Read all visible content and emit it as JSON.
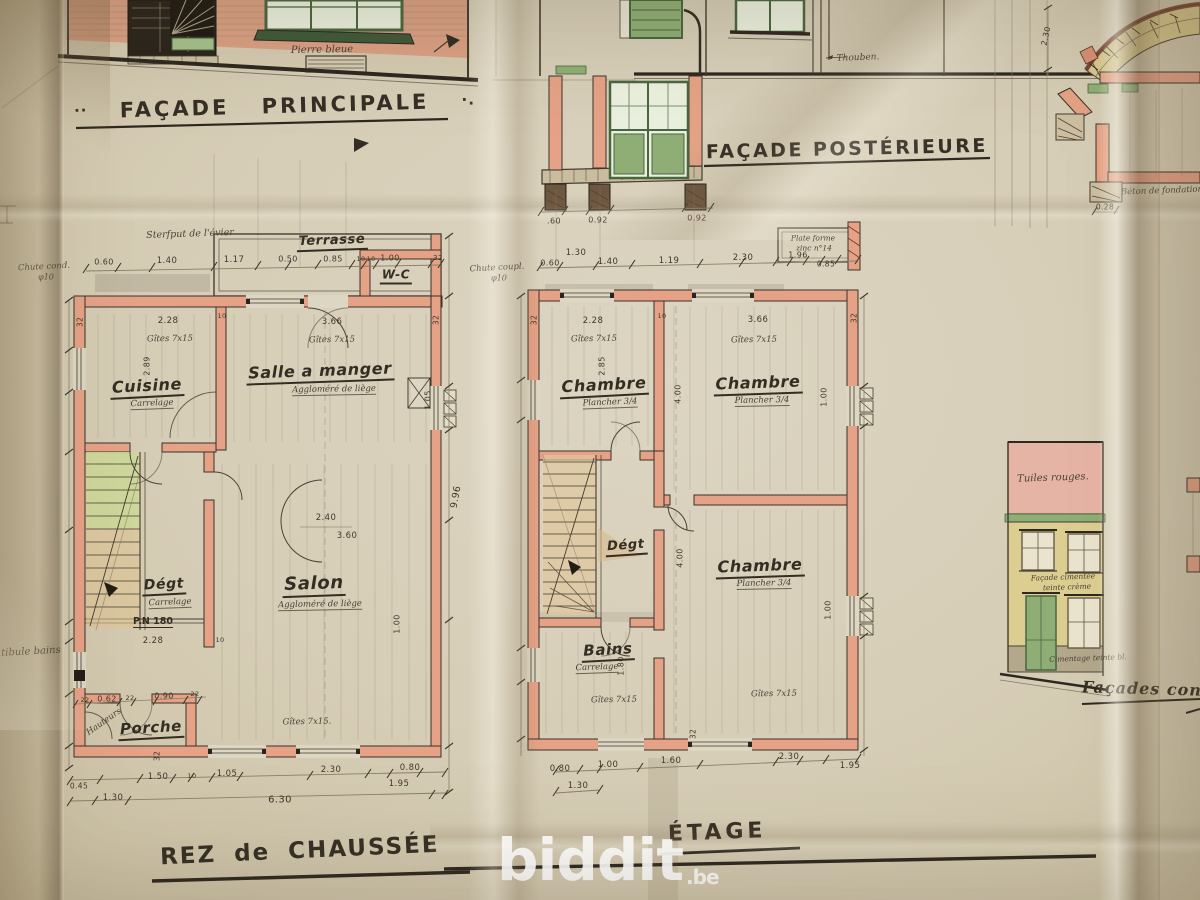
{
  "palette": {
    "paper": "#d6cdb6",
    "ink": "#443c2f",
    "wall_salmon": "#e5a286",
    "joinery_green": "#8fae75",
    "brick_yellow": "#d8c98f",
    "roof_pink": "#e6b4a5",
    "stair_green": "#ccd897",
    "watermark_white": "#ffffff"
  },
  "titles": {
    "principale": {
      "pre": "··",
      "text": "FAÇADE PRINCIPALE",
      "post": "·."
    },
    "posterieure": {
      "text": "FAÇADE POSTÉRIEURE"
    },
    "rdc": {
      "text": "REZ de CHAUSSÉE"
    },
    "etage": {
      "text": "ÉTAGE"
    },
    "laterales": {
      "text": "Façades con"
    }
  },
  "watermark": {
    "text": "biddit",
    "tld": ".be"
  },
  "ann": {
    "principale": [
      {
        "t": "Pierre bleue",
        "x": 322,
        "y": 50,
        "c": "cur",
        "s": 10,
        "r": -1
      }
    ],
    "posterieure": [
      {
        "t": "Thouben.",
        "x": 858,
        "y": 58,
        "c": "cur",
        "s": 9,
        "r": -2
      },
      {
        "t": ".60",
        "x": 554,
        "y": 221,
        "c": "dim",
        "s": 8
      },
      {
        "t": "0.92",
        "x": 598,
        "y": 220,
        "c": "dim",
        "s": 8
      },
      {
        "t": "0.92",
        "x": 697,
        "y": 218,
        "c": "dim",
        "s": 8
      }
    ],
    "rdc": [
      {
        "t": "Sterfput de l'évier",
        "x": 190,
        "y": 234,
        "c": "cur",
        "s": 9.5,
        "r": -2
      },
      {
        "t": "Terrasse",
        "x": 332,
        "y": 242,
        "c": "room",
        "s": 13,
        "r": -2
      },
      {
        "t": "W-C",
        "x": 396,
        "y": 276,
        "c": "room",
        "s": 12
      },
      {
        "t": "Chute cond.",
        "x": 44,
        "y": 267,
        "c": "cur",
        "s": 8.5,
        "r": -3
      },
      {
        "t": "φ10",
        "x": 46,
        "y": 277,
        "c": "cur",
        "s": 8
      },
      {
        "t": "0.60",
        "x": 104,
        "y": 262,
        "c": "dim",
        "s": 8
      },
      {
        "t": "1.40",
        "x": 167,
        "y": 261,
        "c": "dim"
      },
      {
        "t": "1.17",
        "x": 234,
        "y": 260,
        "c": "dim"
      },
      {
        "t": "0.50",
        "x": 288,
        "y": 259,
        "c": "dim",
        "s": 8
      },
      {
        "t": "0.85",
        "x": 333,
        "y": 259,
        "c": "dim",
        "s": 8
      },
      {
        "t": "10",
        "x": 361,
        "y": 259,
        "c": "dim",
        "s": 6.5
      },
      {
        "t": "10",
        "x": 371,
        "y": 259,
        "c": "dim",
        "s": 6.5
      },
      {
        "t": "1.00",
        "x": 390,
        "y": 258,
        "c": "dim",
        "s": 8
      },
      {
        "t": "32",
        "x": 438,
        "y": 258,
        "c": "dim",
        "s": 7
      },
      {
        "t": "32",
        "x": 80,
        "y": 322,
        "c": "dim",
        "s": 7.5,
        "r": -90
      },
      {
        "t": "10",
        "x": 222,
        "y": 316,
        "c": "dim",
        "s": 6.5
      },
      {
        "t": "32",
        "x": 436,
        "y": 320,
        "c": "dim",
        "s": 7.5,
        "r": -90
      },
      {
        "t": "2.28",
        "x": 168,
        "y": 321,
        "c": "dim"
      },
      {
        "t": "3.66",
        "x": 332,
        "y": 322,
        "c": "dim"
      },
      {
        "t": "Gîtes 7x15",
        "x": 170,
        "y": 339,
        "c": "cur",
        "s": 8.5,
        "r": -1
      },
      {
        "t": "Gîtes 7x15",
        "x": 332,
        "y": 340,
        "c": "cur",
        "s": 8.5,
        "r": -1
      },
      {
        "t": "2.89",
        "x": 147,
        "y": 366,
        "c": "dim",
        "s": 8,
        "r": -90
      },
      {
        "t": "Cuisine",
        "x": 147,
        "y": 387,
        "c": "room",
        "s": 16,
        "r": -3
      },
      {
        "t": "Carrelage",
        "x": 152,
        "y": 404,
        "c": "mat",
        "r": -2
      },
      {
        "t": "Salle a manger",
        "x": 320,
        "y": 372,
        "c": "room",
        "s": 16,
        "r": -2
      },
      {
        "t": "Aggloméré de liège",
        "x": 334,
        "y": 390,
        "c": "mat",
        "r": -1
      },
      {
        "t": "1.05",
        "x": 428,
        "y": 400,
        "c": "dim",
        "s": 8,
        "r": -90
      },
      {
        "t": "2.40",
        "x": 326,
        "y": 518,
        "c": "dim"
      },
      {
        "t": "3.60",
        "x": 347,
        "y": 536,
        "c": "dim"
      },
      {
        "t": "9.96",
        "x": 456,
        "y": 497,
        "c": "dim",
        "s": 9.5,
        "r": -80
      },
      {
        "t": "Dégt",
        "x": 164,
        "y": 586,
        "c": "room",
        "s": 14,
        "r": -3
      },
      {
        "t": "Carrelage",
        "x": 170,
        "y": 603,
        "c": "mat",
        "r": -2
      },
      {
        "t": "Salon",
        "x": 314,
        "y": 585,
        "c": "room",
        "s": 18,
        "r": -2
      },
      {
        "t": "Aggloméré de liège",
        "x": 320,
        "y": 605,
        "c": "mat",
        "r": -1
      },
      {
        "t": "P.N 180",
        "x": 153,
        "y": 622,
        "c": "pnl"
      },
      {
        "t": "2.28",
        "x": 153,
        "y": 641,
        "c": "dim"
      },
      {
        "t": "10",
        "x": 220,
        "y": 640,
        "c": "dim",
        "s": 6.5
      },
      {
        "t": "1.00",
        "x": 397,
        "y": 624,
        "c": "dim",
        "s": 8,
        "r": -90
      },
      {
        "t": "Hauteurs",
        "x": 104,
        "y": 722,
        "c": "cur",
        "s": 8.5,
        "r": -35
      },
      {
        "t": "22",
        "x": 85,
        "y": 700,
        "c": "dim",
        "s": 6.5
      },
      {
        "t": "0.62",
        "x": 107,
        "y": 699,
        "c": "dim",
        "s": 8
      },
      {
        "t": "22",
        "x": 130,
        "y": 698,
        "c": "dim",
        "s": 6.5
      },
      {
        "t": "0.90",
        "x": 164,
        "y": 696,
        "c": "dim",
        "s": 8
      },
      {
        "t": "22",
        "x": 195,
        "y": 694,
        "c": "dim",
        "s": 6.5
      },
      {
        "t": "Porche",
        "x": 151,
        "y": 729,
        "c": "room",
        "s": 15,
        "r": -3
      },
      {
        "t": "32",
        "x": 157,
        "y": 756,
        "c": "dim",
        "s": 7.5,
        "r": -90
      },
      {
        "t": "Gîtes 7x15.",
        "x": 307,
        "y": 722,
        "c": "cur",
        "s": 8.5,
        "r": -1
      },
      {
        "t": "1.50",
        "x": 158,
        "y": 777,
        "c": "dim"
      },
      {
        "t": "10",
        "x": 192,
        "y": 776,
        "c": "dim",
        "s": 6.5
      },
      {
        "t": "1.05",
        "x": 227,
        "y": 774,
        "c": "dim"
      },
      {
        "t": "2.30",
        "x": 331,
        "y": 770,
        "c": "dim"
      },
      {
        "t": "0.80",
        "x": 410,
        "y": 768,
        "c": "dim"
      },
      {
        "t": "1.95",
        "x": 399,
        "y": 784,
        "c": "dim"
      },
      {
        "t": "0.45",
        "x": 79,
        "y": 786,
        "c": "dim",
        "s": 7.5
      },
      {
        "t": "1.30",
        "x": 113,
        "y": 798,
        "c": "dim"
      },
      {
        "t": "6.30",
        "x": 280,
        "y": 800,
        "c": "dim",
        "s": 10
      },
      {
        "t": "…tibule bains",
        "x": 26,
        "y": 652,
        "c": "cur",
        "s": 10,
        "r": -3
      }
    ],
    "etage": [
      {
        "t": "Plate forme",
        "x": 813,
        "y": 238,
        "c": "cur",
        "s": 7.5
      },
      {
        "t": "zinc n°14",
        "x": 814,
        "y": 248,
        "c": "cur",
        "s": 7.5
      },
      {
        "t": "Chute coupl.",
        "x": 497,
        "y": 268,
        "c": "cur",
        "s": 8.5,
        "r": -3
      },
      {
        "t": "φ10",
        "x": 499,
        "y": 278,
        "c": "cur",
        "s": 8
      },
      {
        "t": "1.30",
        "x": 576,
        "y": 253,
        "c": "dim"
      },
      {
        "t": "0.60",
        "x": 550,
        "y": 263,
        "c": "dim",
        "s": 8
      },
      {
        "t": "1.40",
        "x": 608,
        "y": 262,
        "c": "dim"
      },
      {
        "t": "1.19",
        "x": 669,
        "y": 261,
        "c": "dim"
      },
      {
        "t": "2.30",
        "x": 743,
        "y": 258,
        "c": "dim"
      },
      {
        "t": "1.96",
        "x": 798,
        "y": 255,
        "c": "dim",
        "s": 8
      },
      {
        "t": "0.85",
        "x": 826,
        "y": 264,
        "c": "dim",
        "s": 7.5
      },
      {
        "t": "32",
        "x": 534,
        "y": 320,
        "c": "dim",
        "s": 7.5,
        "r": -90
      },
      {
        "t": "2.28",
        "x": 593,
        "y": 321,
        "c": "dim"
      },
      {
        "t": "10",
        "x": 662,
        "y": 316,
        "c": "dim",
        "s": 6.5
      },
      {
        "t": "3.66",
        "x": 758,
        "y": 320,
        "c": "dim"
      },
      {
        "t": "32",
        "x": 854,
        "y": 318,
        "c": "dim",
        "s": 7.5,
        "r": -90
      },
      {
        "t": "Gîtes 7x15",
        "x": 594,
        "y": 339,
        "c": "cur",
        "s": 8.5,
        "r": -1
      },
      {
        "t": "Gîtes 7x15",
        "x": 754,
        "y": 340,
        "c": "cur",
        "s": 8.5,
        "r": -1
      },
      {
        "t": "2.85",
        "x": 602,
        "y": 366,
        "c": "dim",
        "s": 8,
        "r": -90
      },
      {
        "t": "Chambre",
        "x": 604,
        "y": 386,
        "c": "room",
        "s": 16,
        "r": -3
      },
      {
        "t": "Plancher 3/4",
        "x": 610,
        "y": 403,
        "c": "mat",
        "r": -2
      },
      {
        "t": "Chambre",
        "x": 758,
        "y": 384,
        "c": "room",
        "s": 16,
        "r": -2
      },
      {
        "t": "Plancher 3/4",
        "x": 762,
        "y": 401,
        "c": "mat",
        "r": -1
      },
      {
        "t": "1.00",
        "x": 824,
        "y": 397,
        "c": "dim",
        "s": 8,
        "r": -90
      },
      {
        "t": "4.00",
        "x": 678,
        "y": 394,
        "c": "dim",
        "s": 8,
        "r": -90
      },
      {
        "t": "Dégt",
        "x": 626,
        "y": 547,
        "c": "room",
        "s": 13,
        "r": -4
      },
      {
        "t": "4.00",
        "x": 680,
        "y": 558,
        "c": "dim",
        "s": 8,
        "r": -90
      },
      {
        "t": "Chambre",
        "x": 760,
        "y": 567,
        "c": "room",
        "s": 16,
        "r": -2
      },
      {
        "t": "Plancher 3/4",
        "x": 764,
        "y": 584,
        "c": "mat",
        "r": -1
      },
      {
        "t": "1.00",
        "x": 828,
        "y": 610,
        "c": "dim",
        "s": 8,
        "r": -90
      },
      {
        "t": "Bains",
        "x": 608,
        "y": 651,
        "c": "room",
        "s": 15,
        "r": -3
      },
      {
        "t": "Carrelage",
        "x": 597,
        "y": 668,
        "c": "mat",
        "r": -2
      },
      {
        "t": "1.80",
        "x": 621,
        "y": 666,
        "c": "dim",
        "s": 8,
        "r": -90
      },
      {
        "t": "Gîtes 7x15",
        "x": 614,
        "y": 700,
        "c": "cur",
        "s": 8.5,
        "r": -1
      },
      {
        "t": "Gîtes 7x15",
        "x": 774,
        "y": 694,
        "c": "cur",
        "s": 8.5,
        "r": -1
      },
      {
        "t": "32",
        "x": 693,
        "y": 734,
        "c": "dim",
        "s": 7.5,
        "r": -90
      },
      {
        "t": "0.80",
        "x": 560,
        "y": 769,
        "c": "dim"
      },
      {
        "t": "1.00",
        "x": 608,
        "y": 765,
        "c": "dim"
      },
      {
        "t": "1.60",
        "x": 671,
        "y": 761,
        "c": "dim"
      },
      {
        "t": "2.30",
        "x": 789,
        "y": 757,
        "c": "dim"
      },
      {
        "t": "1.95",
        "x": 850,
        "y": 766,
        "c": "dim"
      },
      {
        "t": "1.30",
        "x": 578,
        "y": 786,
        "c": "dim"
      }
    ],
    "laterale": [
      {
        "t": "Tuiles rouges.",
        "x": 1053,
        "y": 478,
        "c": "cur",
        "s": 10,
        "r": -2
      },
      {
        "t": "Façade cimentée",
        "x": 1063,
        "y": 577,
        "c": "cur",
        "s": 7.5,
        "r": -2
      },
      {
        "t": "teinte crème",
        "x": 1067,
        "y": 587,
        "c": "cur",
        "s": 7.5,
        "r": -2
      },
      {
        "t": "Cimentage teinte bl.",
        "x": 1088,
        "y": 658,
        "c": "cur",
        "s": 7.5,
        "r": -2
      }
    ],
    "coupe": [
      {
        "t": "Béton de fondation",
        "x": 1162,
        "y": 191,
        "c": "cur",
        "s": 8.5,
        "r": -2
      },
      {
        "t": "0.28",
        "x": 1105,
        "y": 207,
        "c": "dim",
        "s": 7.5
      },
      {
        "t": "2.30",
        "x": 1046,
        "y": 36,
        "c": "dim",
        "s": 8,
        "r": -78
      }
    ]
  }
}
